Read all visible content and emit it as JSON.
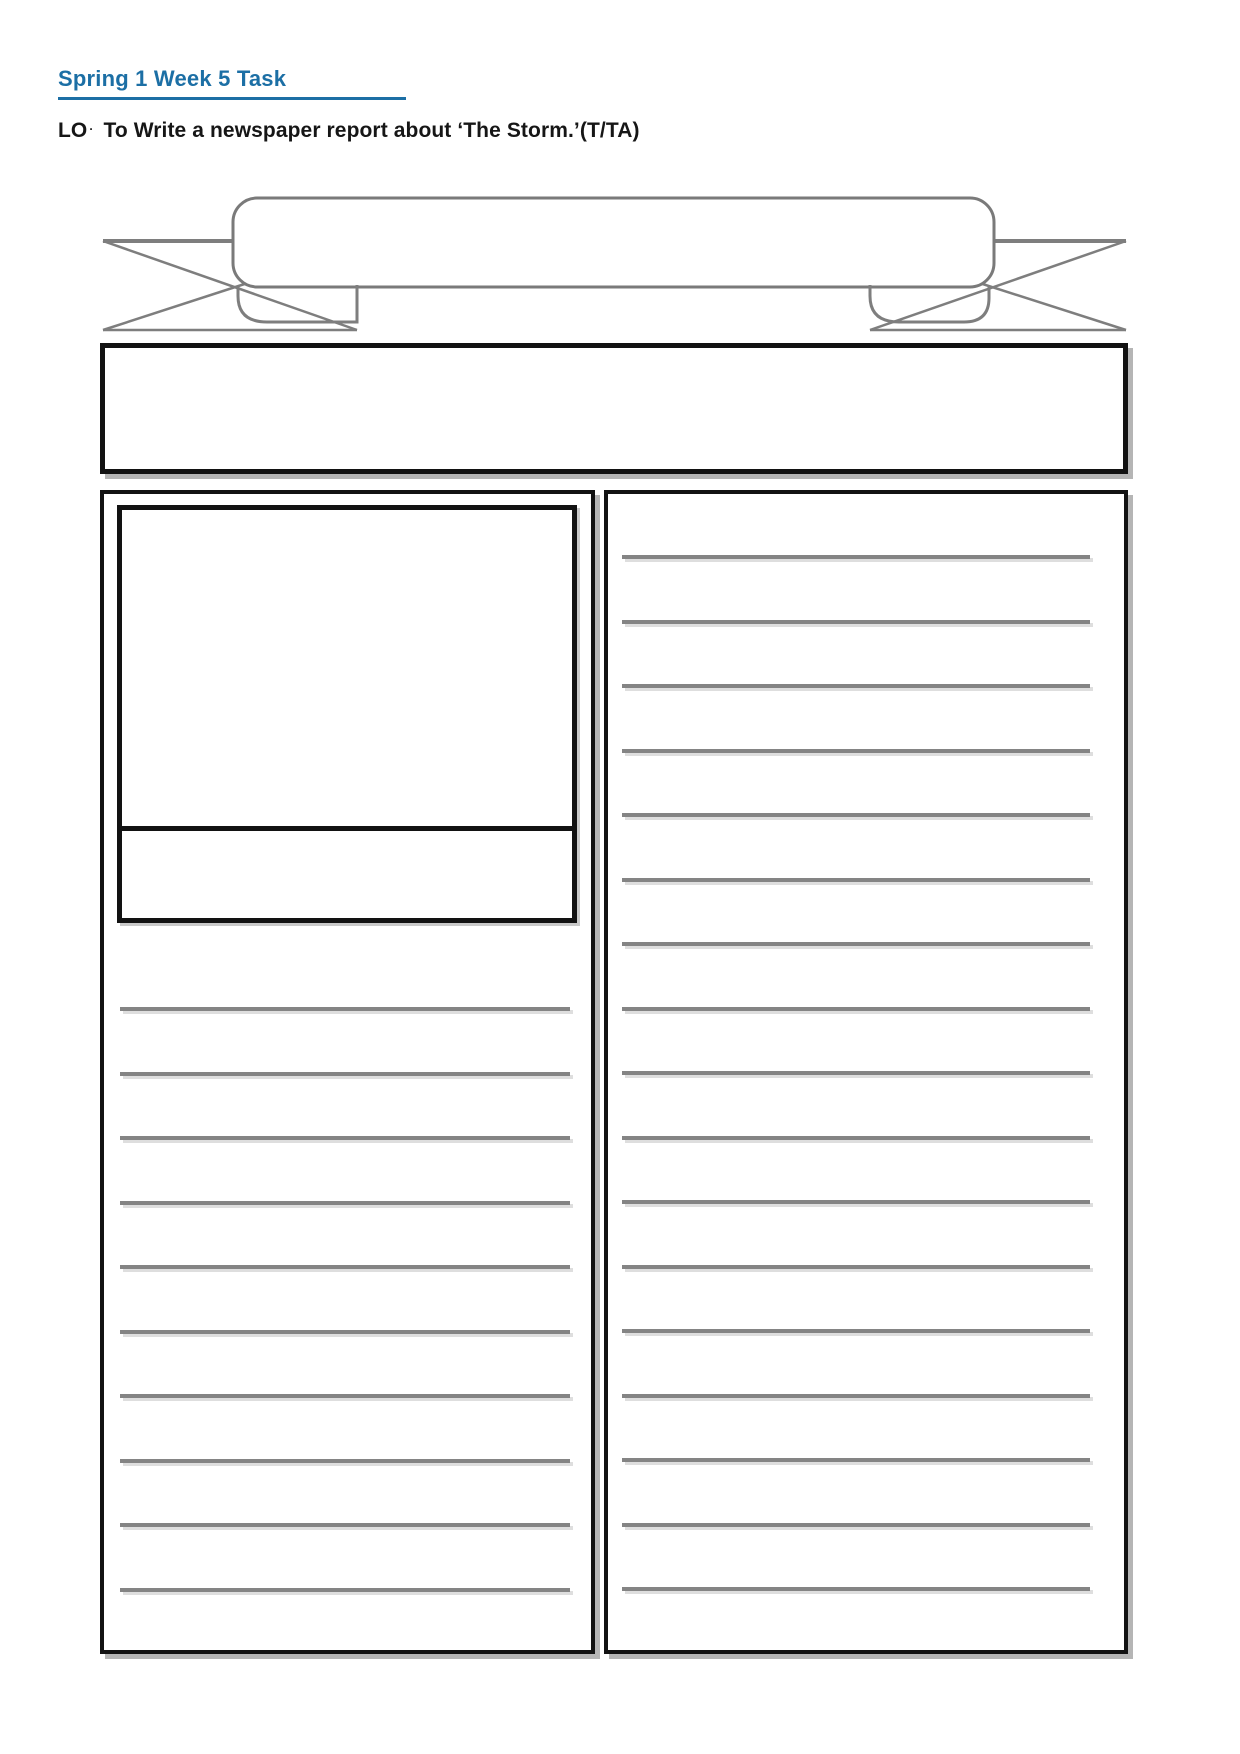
{
  "page": {
    "background": "#ffffff",
    "accent_color": "#1c6fa5",
    "border_color": "#121212",
    "line_color": "#848484"
  },
  "header": {
    "title": "Spring 1 Week 5 Task",
    "objective_prefix": "LO",
    "objective_separator": "·",
    "objective_text": "To Write a newspaper report about ‘The Storm.’(T/TA)"
  },
  "template": {
    "banner": {
      "value": ""
    },
    "headline_box": {
      "value": ""
    },
    "left_column": {
      "picture_box": {
        "value": ""
      },
      "caption_box": {
        "value": ""
      },
      "ruled_lines": 10
    },
    "right_column": {
      "ruled_lines": 17
    }
  }
}
